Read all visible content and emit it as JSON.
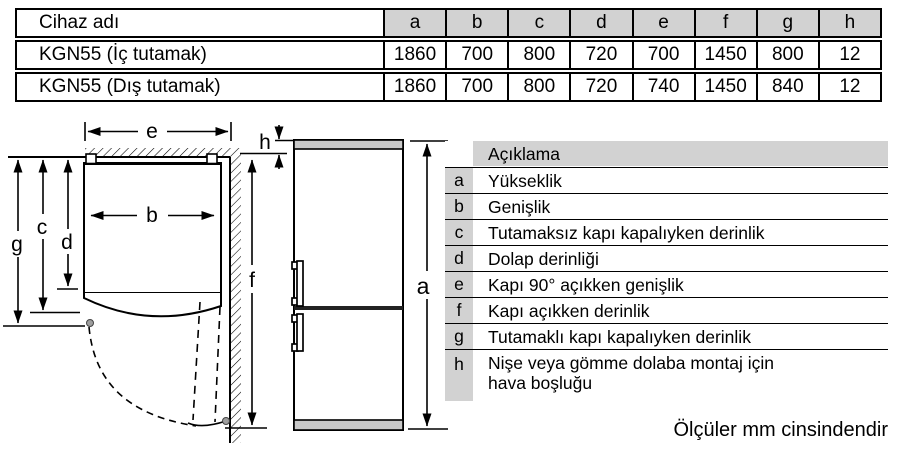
{
  "table": {
    "device_column_header": "Cihaz adı",
    "dim_headers": [
      "a",
      "b",
      "c",
      "d",
      "e",
      "f",
      "g",
      "h"
    ],
    "rows": [
      {
        "name": "KGN55 (İç tutamak)",
        "values": [
          "1860",
          "700",
          "800",
          "720",
          "700",
          "1450",
          "800",
          "12"
        ]
      },
      {
        "name": "KGN55 (Dış tutamak)",
        "values": [
          "1860",
          "700",
          "800",
          "720",
          "740",
          "1450",
          "840",
          "12"
        ]
      }
    ]
  },
  "legend": {
    "header": "Açıklama",
    "items": [
      {
        "key": "a",
        "text": "Yükseklik"
      },
      {
        "key": "b",
        "text": "Genişlik"
      },
      {
        "key": "c",
        "text": "Tutamaksız kapı kapalıyken derinlik"
      },
      {
        "key": "d",
        "text": "Dolap derinliği"
      },
      {
        "key": "e",
        "text": "Kapı 90° açıkken genişlik"
      },
      {
        "key": "f",
        "text": "Kapı açıkken derinlik"
      },
      {
        "key": "g",
        "text": "Tutamaklı kapı kapalıyken derinlik"
      },
      {
        "key": "h",
        "text": "Nişe veya gömme dolaba montaj için hava boşluğu"
      }
    ]
  },
  "diagram_labels": {
    "e": "e",
    "h": "h",
    "b": "b",
    "c": "c",
    "d": "d",
    "g": "g",
    "f": "f",
    "a": "a"
  },
  "footnote": "Ölçüler mm cinsindendir",
  "colors": {
    "cell_gray": "#d2d2d2",
    "strip_gray": "#c9c9c9",
    "line_black": "#000000"
  }
}
